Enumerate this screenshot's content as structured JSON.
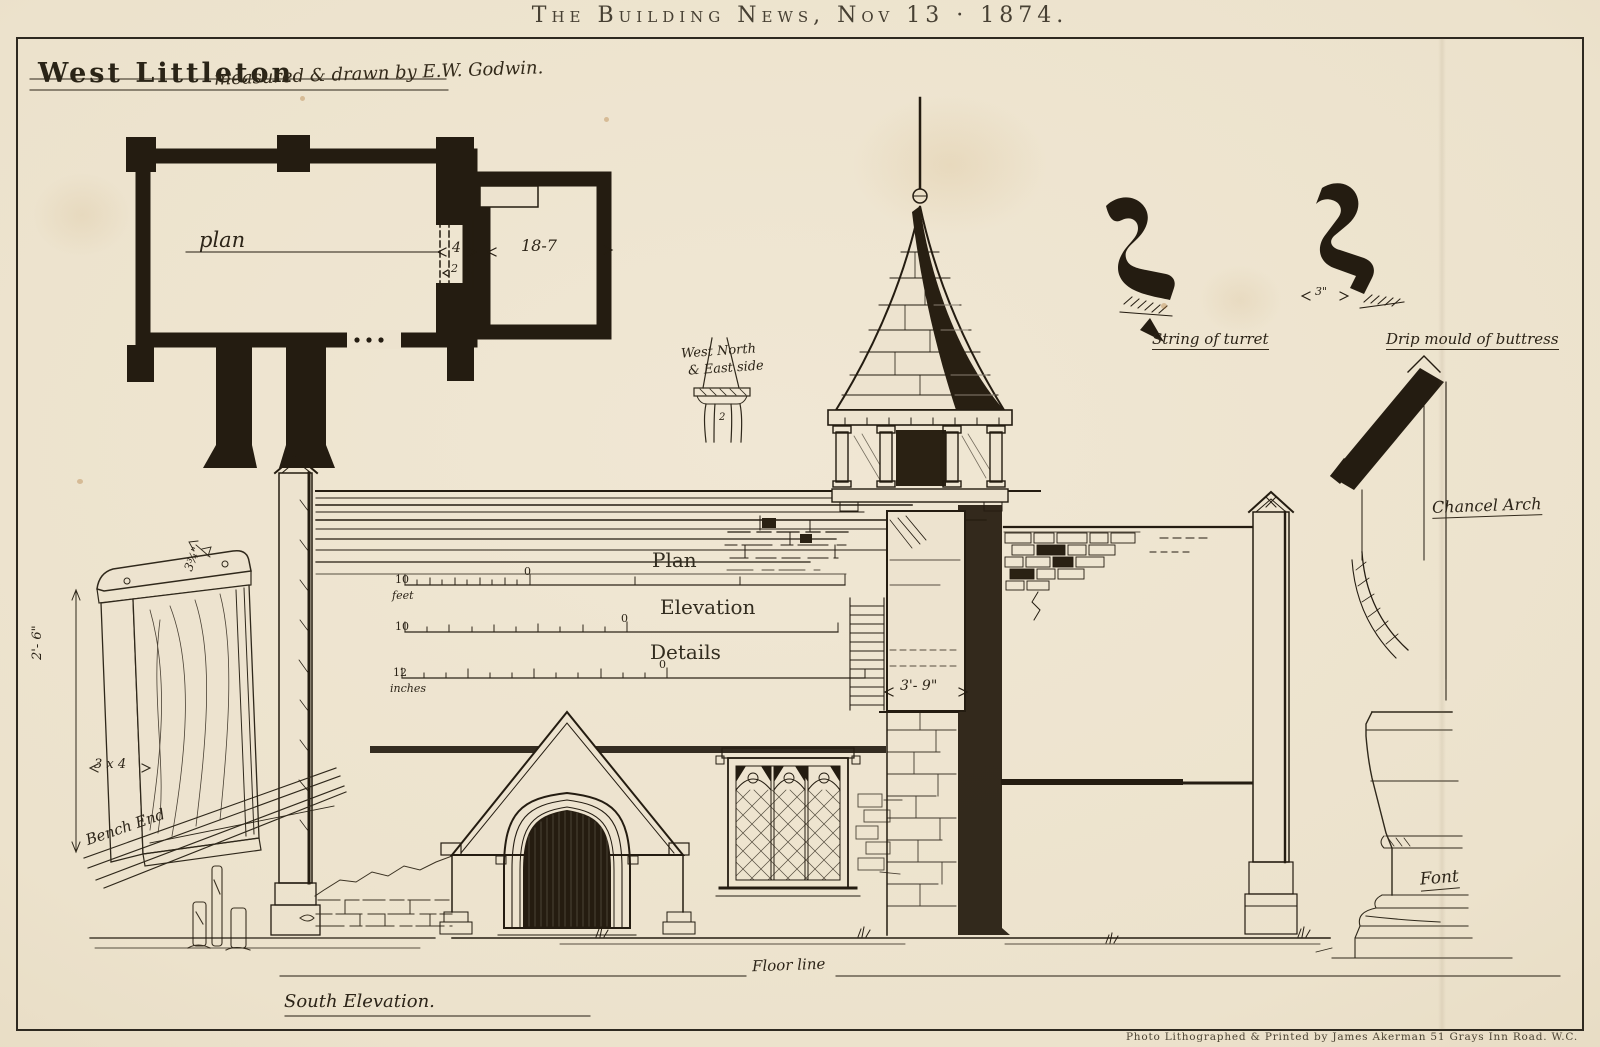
{
  "masthead": {
    "title": "The Building News, Nov 13 · 1874."
  },
  "header": {
    "place": "West Littleton",
    "byline": "measured & drawn by E.W. Godwin."
  },
  "plan": {
    "label": "plan",
    "arch_width": "4",
    "arch_depth": "2",
    "chancel_length": "18-7"
  },
  "scale_bars": {
    "plan": {
      "label": "Plan",
      "start": "10",
      "unit": "feet",
      "zero": "0"
    },
    "elevation": {
      "label": "Elevation",
      "start": "10",
      "zero": "0"
    },
    "details": {
      "label": "Details",
      "start": "12",
      "unit": "inches",
      "zero": "0"
    }
  },
  "elevation": {
    "label": "South Elevation.",
    "floor_line": "Floor line",
    "turret_width": "3'- 9\""
  },
  "details": {
    "bench_end": {
      "label": "Bench End",
      "height": "2'- 6\"",
      "section": "3 x 4",
      "thickness": "3¾\""
    },
    "side_detail": {
      "line1": "West North",
      "line2": "& East side",
      "dim": "2"
    },
    "string_of_turret": {
      "label": "String of turret"
    },
    "drip_mould": {
      "label": "Drip mould of buttress",
      "dim": "3\""
    },
    "chancel_arch": {
      "label": "Chancel Arch"
    },
    "font": {
      "label": "Font"
    }
  },
  "imprint": {
    "credit": "Photo Lithographed & Printed by James Akerman 51 Grays Inn Road. W.C."
  },
  "colors": {
    "paper": "#ede3cf",
    "ink": "#241c11",
    "handwriting": "#2c2418"
  }
}
